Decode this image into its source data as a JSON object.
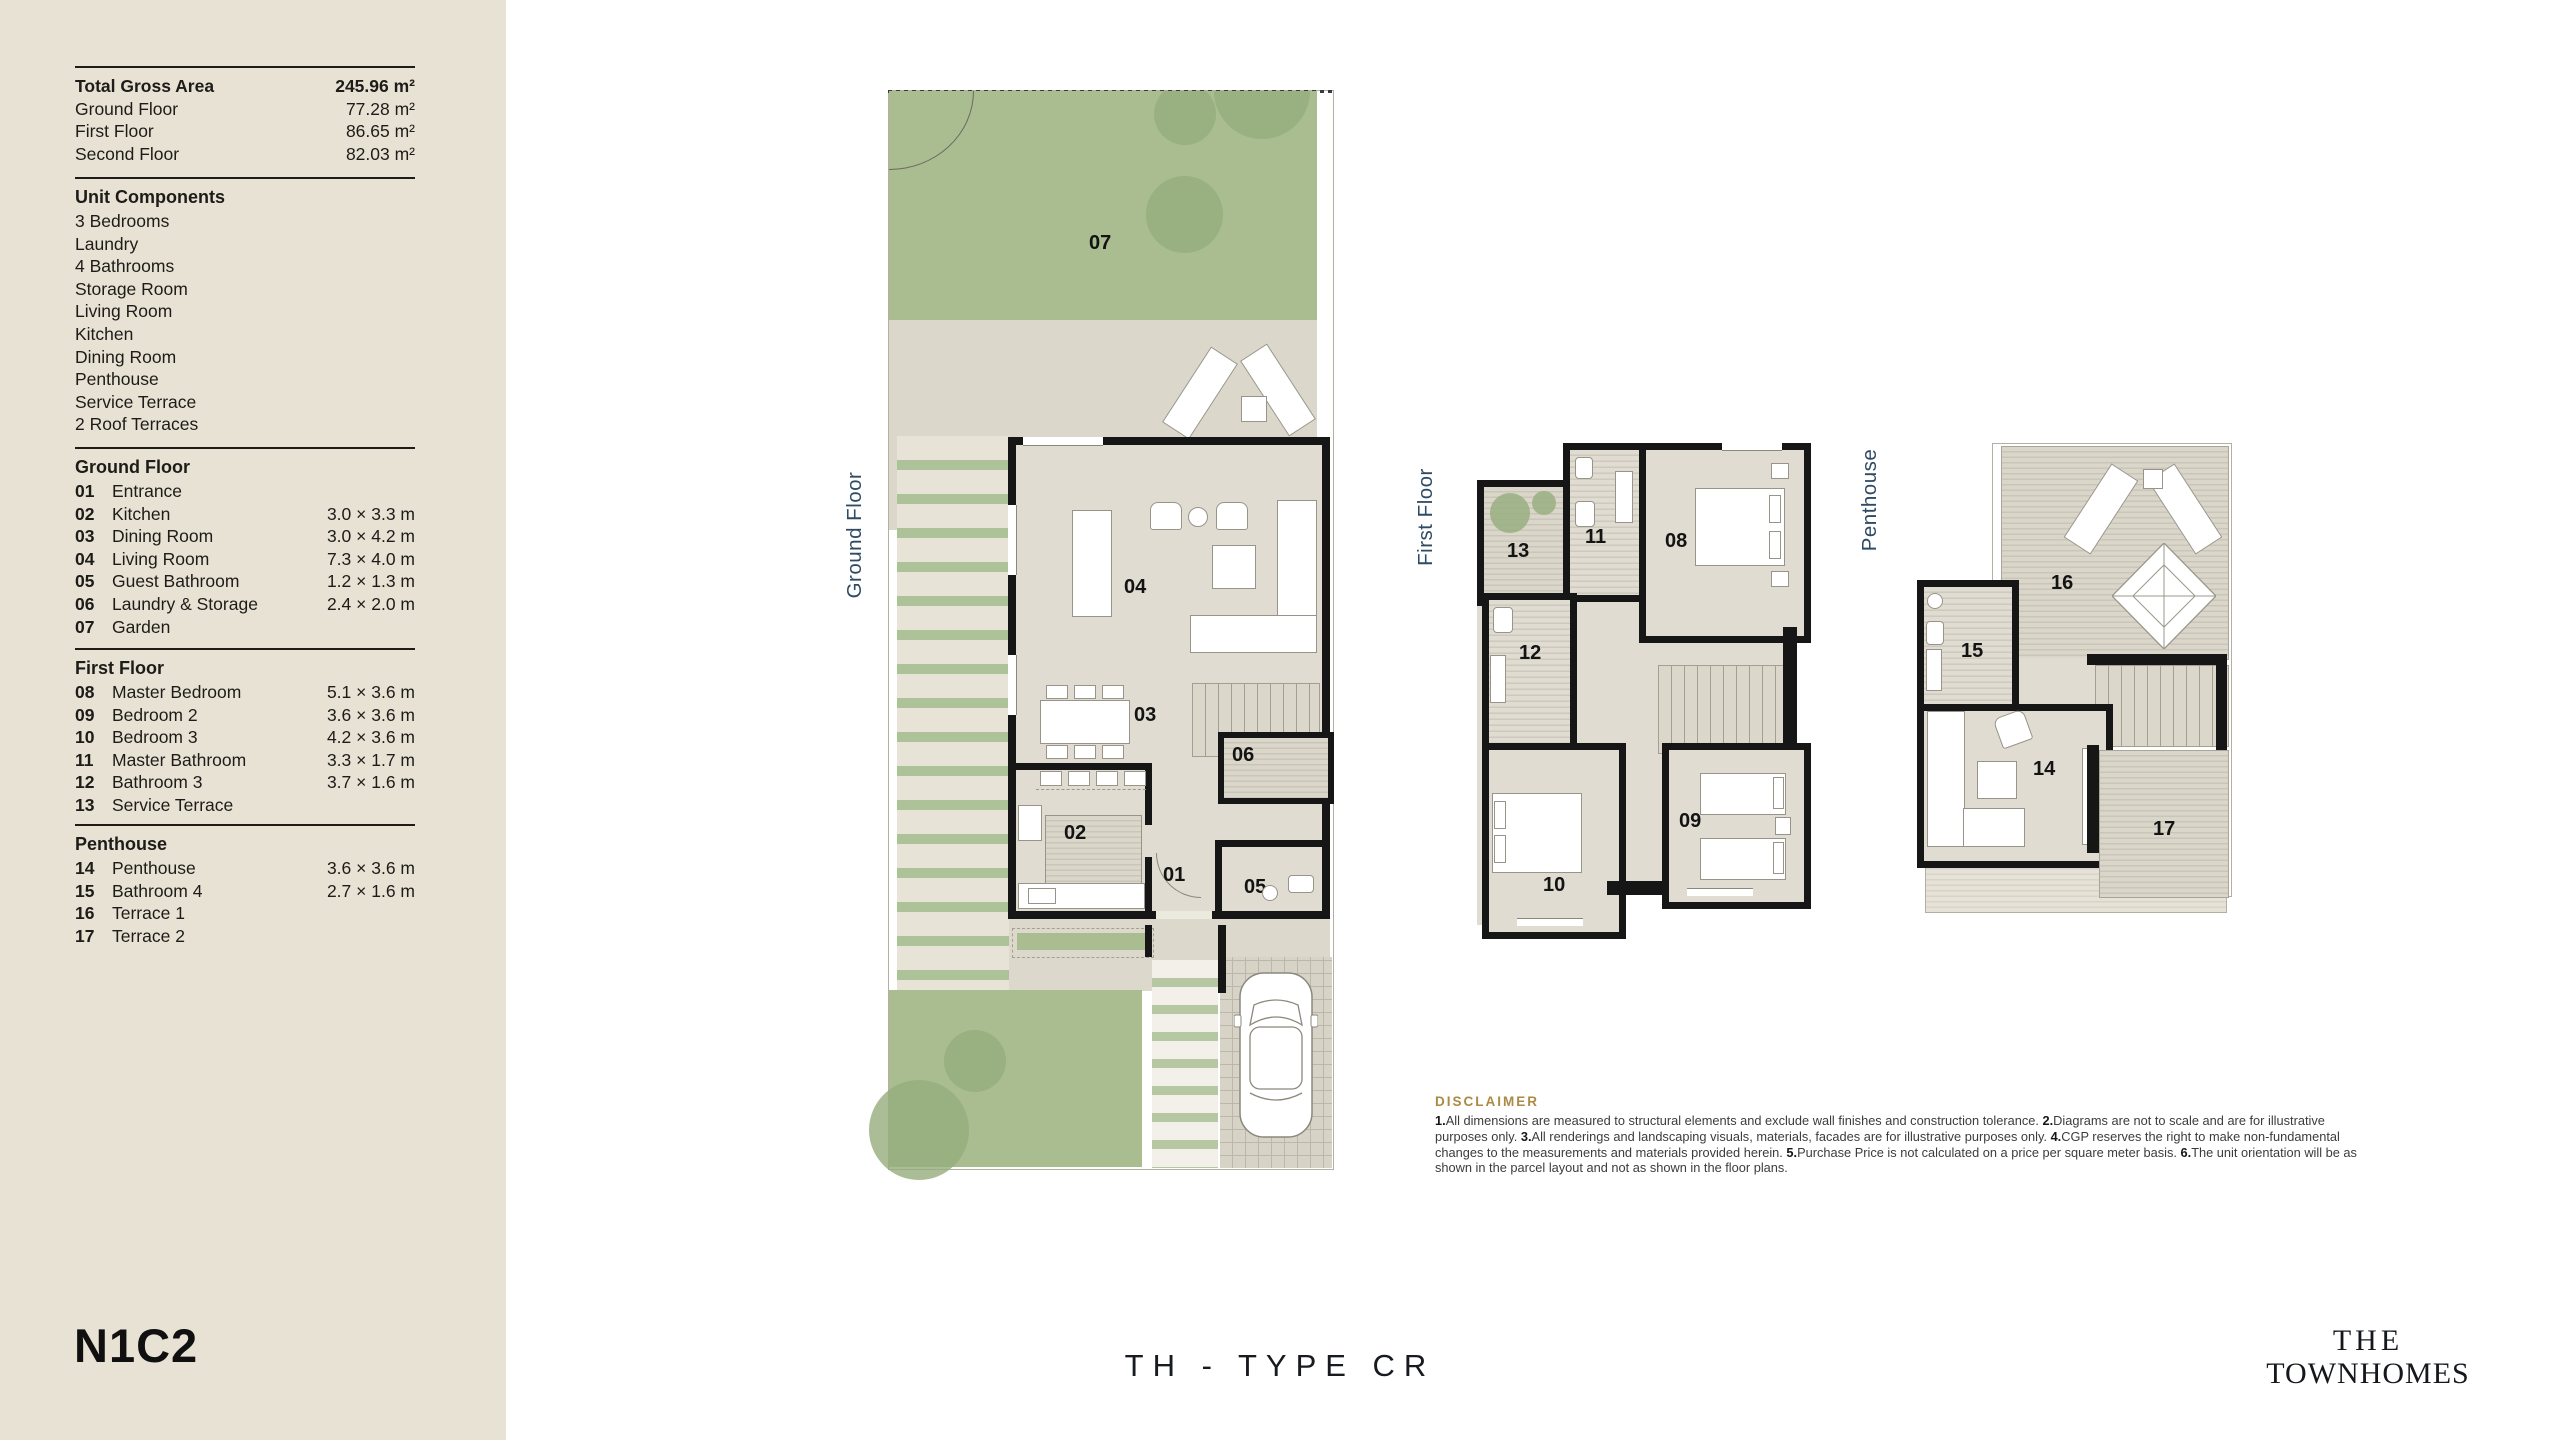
{
  "sidebar": {
    "areas": {
      "rows": [
        {
          "label": "Total Gross Area",
          "value": "245.96 m²"
        },
        {
          "label": "Ground Floor",
          "value": "77.28 m²"
        },
        {
          "label": "First Floor",
          "value": "86.65 m²"
        },
        {
          "label": "Second Floor",
          "value": "82.03 m²"
        }
      ]
    },
    "unit_components": {
      "title": "Unit Components",
      "items": [
        "3 Bedrooms",
        "Laundry",
        "4 Bathrooms",
        "Storage Room",
        "Living Room",
        "Kitchen",
        "Dining Room",
        "Penthouse",
        "Service Terrace",
        "2 Roof Terraces"
      ]
    },
    "ground_floor": {
      "title": "Ground Floor",
      "rooms": [
        {
          "num": "01",
          "name": "Entrance",
          "dims": ""
        },
        {
          "num": "02",
          "name": "Kitchen",
          "dims": "3.0 × 3.3 m"
        },
        {
          "num": "03",
          "name": "Dining Room",
          "dims": "3.0 × 4.2 m"
        },
        {
          "num": "04",
          "name": "Living Room",
          "dims": "7.3 × 4.0 m"
        },
        {
          "num": "05",
          "name": "Guest Bathroom",
          "dims": "1.2 × 1.3 m"
        },
        {
          "num": "06",
          "name": "Laundry & Storage",
          "dims": "2.4 × 2.0 m"
        },
        {
          "num": "07",
          "name": "Garden",
          "dims": ""
        }
      ]
    },
    "first_floor": {
      "title": "First Floor",
      "rooms": [
        {
          "num": "08",
          "name": "Master Bedroom",
          "dims": "5.1 × 3.6 m"
        },
        {
          "num": "09",
          "name": "Bedroom 2",
          "dims": "3.6 × 3.6 m"
        },
        {
          "num": "10",
          "name": "Bedroom 3",
          "dims": "4.2 × 3.6 m"
        },
        {
          "num": "11",
          "name": "Master Bathroom",
          "dims": "3.3 × 1.7 m"
        },
        {
          "num": "12",
          "name": "Bathroom 3",
          "dims": "3.7 × 1.6 m"
        },
        {
          "num": "13",
          "name": "Service Terrace",
          "dims": ""
        }
      ]
    },
    "penthouse": {
      "title": "Penthouse",
      "rooms": [
        {
          "num": "14",
          "name": "Penthouse",
          "dims": "3.6 × 3.6 m"
        },
        {
          "num": "15",
          "name": "Bathroom 4",
          "dims": "2.7 × 1.6 m"
        },
        {
          "num": "16",
          "name": "Terrace 1",
          "dims": ""
        },
        {
          "num": "17",
          "name": "Terrace 2",
          "dims": ""
        }
      ]
    },
    "unit_code": "N1C2"
  },
  "plans": {
    "ground": {
      "label": "Ground Floor",
      "rooms": {
        "entrance": "01",
        "kitchen": "02",
        "dining": "03",
        "living": "04",
        "guest_bath": "05",
        "laundry": "06",
        "garden": "07"
      }
    },
    "first": {
      "label": "First Floor",
      "rooms": {
        "master_bedroom": "08",
        "bedroom2": "09",
        "bedroom3": "10",
        "master_bath": "11",
        "bathroom3": "12",
        "service_terrace": "13"
      }
    },
    "penthouse": {
      "label": "Penthouse",
      "rooms": {
        "penthouse": "14",
        "bathroom4": "15",
        "terrace1": "16",
        "terrace2": "17"
      }
    }
  },
  "disclaimer": {
    "title": "DISCLAIMER",
    "items": [
      {
        "num": "1.",
        "text": "All dimensions are measured to structural elements and exclude wall finishes and construction tolerance."
      },
      {
        "num": "2.",
        "text": "Diagrams are not to scale and are for illustrative purposes only."
      },
      {
        "num": "3.",
        "text": "All renderings and landscaping visuals, materials, facades are for illustrative purposes only."
      },
      {
        "num": "4.",
        "text": "CGP reserves the right to make non-fundamental changes to the measurements and materials provided herein."
      },
      {
        "num": "5.",
        "text": "Purchase Price is not calculated on a price per square meter basis."
      },
      {
        "num": "6.",
        "text": "The unit orientation will be as shown in the parcel layout and not as shown in the floor plans."
      }
    ]
  },
  "footer": {
    "type_label": "TH - TYPE CR",
    "brand_line1": "THE",
    "brand_line2": "TOWNHOMES"
  },
  "colors": {
    "sidebar_beige": "#e8e2d4",
    "plan_label_navy": "#2e4b63",
    "disclaimer_gold": "#ab8a45",
    "garden_green": "#a9bd90",
    "wall_black": "#161616"
  }
}
